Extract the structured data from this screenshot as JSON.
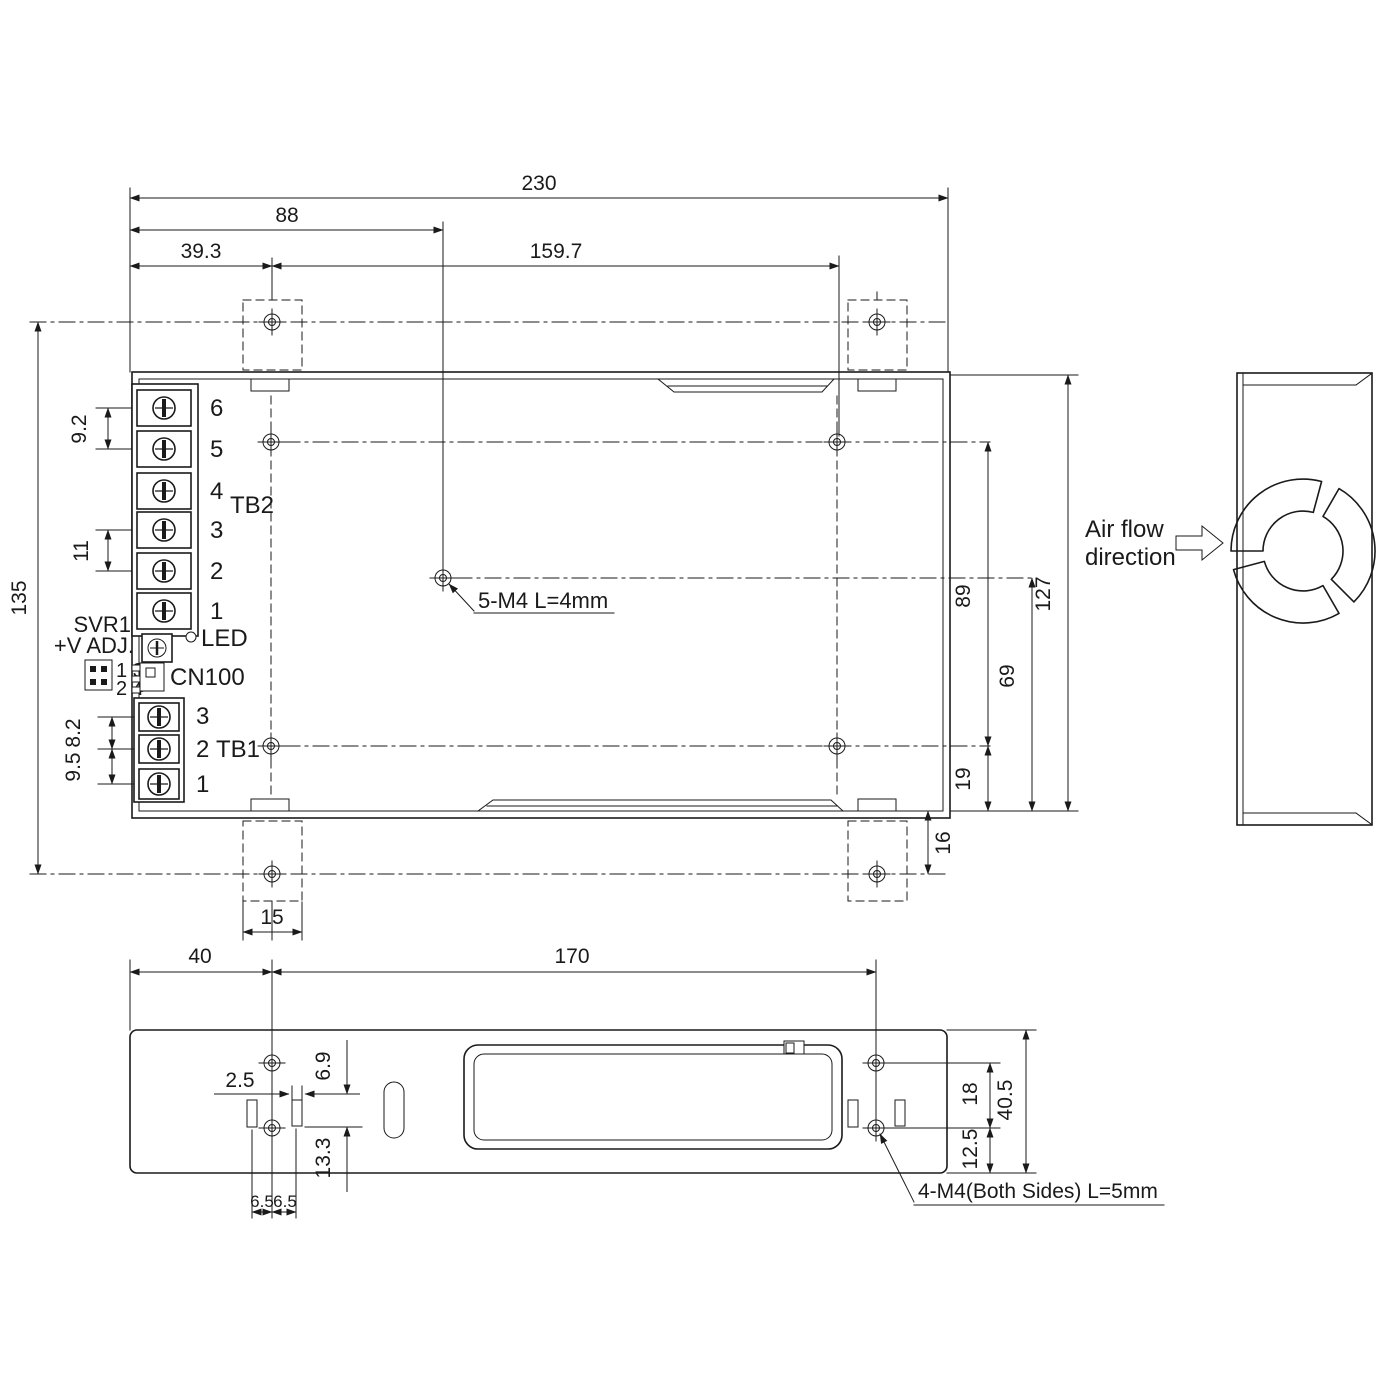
{
  "top_view": {
    "dimensions": {
      "overall_width": "230",
      "center_hole_x": "88",
      "left_hole_x": "39.3",
      "hole_span_x": "159.7",
      "overall_height": "135",
      "tb2_pitch_a": "9.2",
      "tb2_pitch_b": "11",
      "tb1_pitch_a": "8.2",
      "tb1_pitch_b": "9.5",
      "hole_span_y": "89",
      "center_hole_y": "69",
      "bottom_hole_y": "19",
      "body_height": "127",
      "tab_hole_offset": "16",
      "tab_width": "15"
    },
    "callout": "5-M4 L=4mm",
    "tb2": {
      "label": "TB2",
      "terminals": [
        "6",
        "5",
        "4",
        "3",
        "2",
        "1"
      ]
    },
    "tb1": {
      "label": "TB1",
      "terminals": [
        "3",
        "2",
        "1"
      ]
    },
    "components": {
      "svr1": "SVR1",
      "v_adj": "+V ADJ.",
      "led": "LED",
      "cn100": "CN100",
      "pins_row1": "1 3",
      "pins_row2": "2 4"
    }
  },
  "bottom_view": {
    "dimensions": {
      "left_hole_x": "40",
      "hole_span_x": "170",
      "slot_width": "2.5",
      "slot_top_y": "6.9",
      "slot_bottom_y": "13.3",
      "slot_left_x": "6.5",
      "slot_right_x": "6.5",
      "hole_span_y": "18",
      "body_height": "40.5",
      "bottom_hole_y": "12.5"
    },
    "callout": "4-M4(Both Sides) L=5mm"
  },
  "side_view": {
    "airflow_line1": "Air flow",
    "airflow_line2": "direction"
  },
  "colors": {
    "line": "#1a1a1a",
    "background": "#ffffff"
  }
}
